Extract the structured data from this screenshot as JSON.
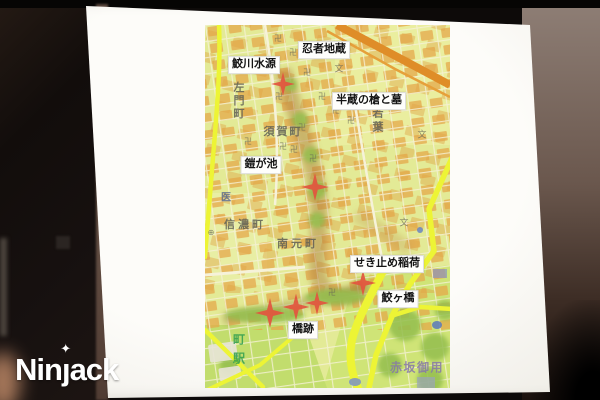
{
  "watermark": {
    "full": "Ninjack",
    "pre": "Nin",
    "j": "ȷ",
    "post": "ack",
    "star": "✦"
  },
  "map": {
    "colors": {
      "marker": "#e2553f",
      "place_text": "#5f5f54",
      "label_bg": "#fefefc",
      "road_yellow": "#edf33f",
      "rail_orange": "#db8e2e",
      "base_green": "#e3ea9a"
    },
    "annotations": [
      {
        "id": "ninja-jizo",
        "text": "忍者地蔵",
        "x": 119,
        "y": 25
      },
      {
        "id": "samegawa-suigen",
        "text": "鮫川水源",
        "x": 49,
        "y": 40
      },
      {
        "id": "hanzo-yari-to-haka",
        "text": "半蔵の槍と墓",
        "x": 164,
        "y": 76
      },
      {
        "id": "yoroigaike",
        "text": "鎧が池",
        "x": 56,
        "y": 140
      },
      {
        "id": "sekitome-inari",
        "text": "せき止め稲荷",
        "x": 182,
        "y": 239
      },
      {
        "id": "samegabashi",
        "text": "鮫ヶ橋",
        "x": 193,
        "y": 274
      },
      {
        "id": "hashiato",
        "text": "橋跡",
        "x": 98,
        "y": 305
      }
    ],
    "markers": [
      {
        "x": 78,
        "y": 59,
        "size": 24
      },
      {
        "x": 110,
        "y": 162,
        "size": 28
      },
      {
        "x": 158,
        "y": 258,
        "size": 26
      },
      {
        "x": 65,
        "y": 288,
        "size": 30
      },
      {
        "x": 91,
        "y": 282,
        "size": 27
      },
      {
        "x": 112,
        "y": 278,
        "size": 24
      }
    ],
    "place_names": [
      {
        "id": "samon-cho",
        "text": "左門町",
        "x": 33,
        "y": 76,
        "size": 11,
        "ls": 2,
        "vertical": true
      },
      {
        "id": "suga-cho",
        "text": "須賀町",
        "x": 78,
        "y": 106,
        "size": 11,
        "ls": 2,
        "vertical": false
      },
      {
        "id": "wakaba",
        "text": "若葉",
        "x": 172,
        "y": 96,
        "size": 11,
        "ls": 3,
        "vertical": true
      },
      {
        "id": "hospital",
        "text": "医",
        "x": 21,
        "y": 171,
        "size": 10,
        "ls": 0,
        "vertical": false,
        "color": "#56688c"
      },
      {
        "id": "shinano-machi",
        "text": "信濃町",
        "x": 40,
        "y": 199,
        "size": 11,
        "ls": 3,
        "vertical": false
      },
      {
        "id": "minamimoto-machi",
        "text": "南元町",
        "x": 93,
        "y": 218,
        "size": 11,
        "ls": 3,
        "vertical": false
      },
      {
        "id": "station",
        "text": "町駅",
        "x": 34,
        "y": 327,
        "size": 12,
        "ls": 7,
        "vertical": true,
        "color": "#2f9e4f"
      },
      {
        "id": "akasaka-goyo",
        "text": "赤坂御用",
        "x": 212,
        "y": 342,
        "size": 12,
        "ls": 1.5,
        "vertical": false,
        "color": "#8678a8"
      }
    ],
    "symbols": [
      {
        "name": "temple-manji-icon",
        "glyph": "卍",
        "x": 73,
        "y": 14
      },
      {
        "name": "temple-manji-icon",
        "glyph": "卍",
        "x": 88,
        "y": 28
      },
      {
        "name": "temple-manji-icon",
        "glyph": "卍",
        "x": 102,
        "y": 48
      },
      {
        "name": "temple-manji-icon",
        "glyph": "卍",
        "x": 117,
        "y": 72
      },
      {
        "name": "temple-manji-icon",
        "glyph": "卍",
        "x": 131,
        "y": 86
      },
      {
        "name": "temple-manji-icon",
        "glyph": "卍",
        "x": 146,
        "y": 96
      },
      {
        "name": "temple-manji-icon",
        "glyph": "卍",
        "x": 74,
        "y": 72
      },
      {
        "name": "temple-manji-icon",
        "glyph": "卍",
        "x": 97,
        "y": 103
      },
      {
        "name": "temple-manji-icon",
        "glyph": "卍",
        "x": 43,
        "y": 117
      },
      {
        "name": "temple-manji-icon",
        "glyph": "卍",
        "x": 78,
        "y": 122
      },
      {
        "name": "temple-manji-icon",
        "glyph": "卍",
        "x": 89,
        "y": 125
      },
      {
        "name": "temple-manji-icon",
        "glyph": "卍",
        "x": 108,
        "y": 134
      },
      {
        "name": "temple-manji-icon",
        "glyph": "卍",
        "x": 127,
        "y": 268
      },
      {
        "name": "school-icon",
        "glyph": "文",
        "x": 134,
        "y": 44,
        "size": 9
      },
      {
        "name": "school-icon",
        "glyph": "文",
        "x": 217,
        "y": 110,
        "size": 9
      },
      {
        "name": "school-icon",
        "glyph": "文",
        "x": 199,
        "y": 198,
        "size": 9
      },
      {
        "name": "clinic-icon",
        "glyph": "⊕",
        "x": 6,
        "y": 208,
        "size": 8
      }
    ]
  }
}
